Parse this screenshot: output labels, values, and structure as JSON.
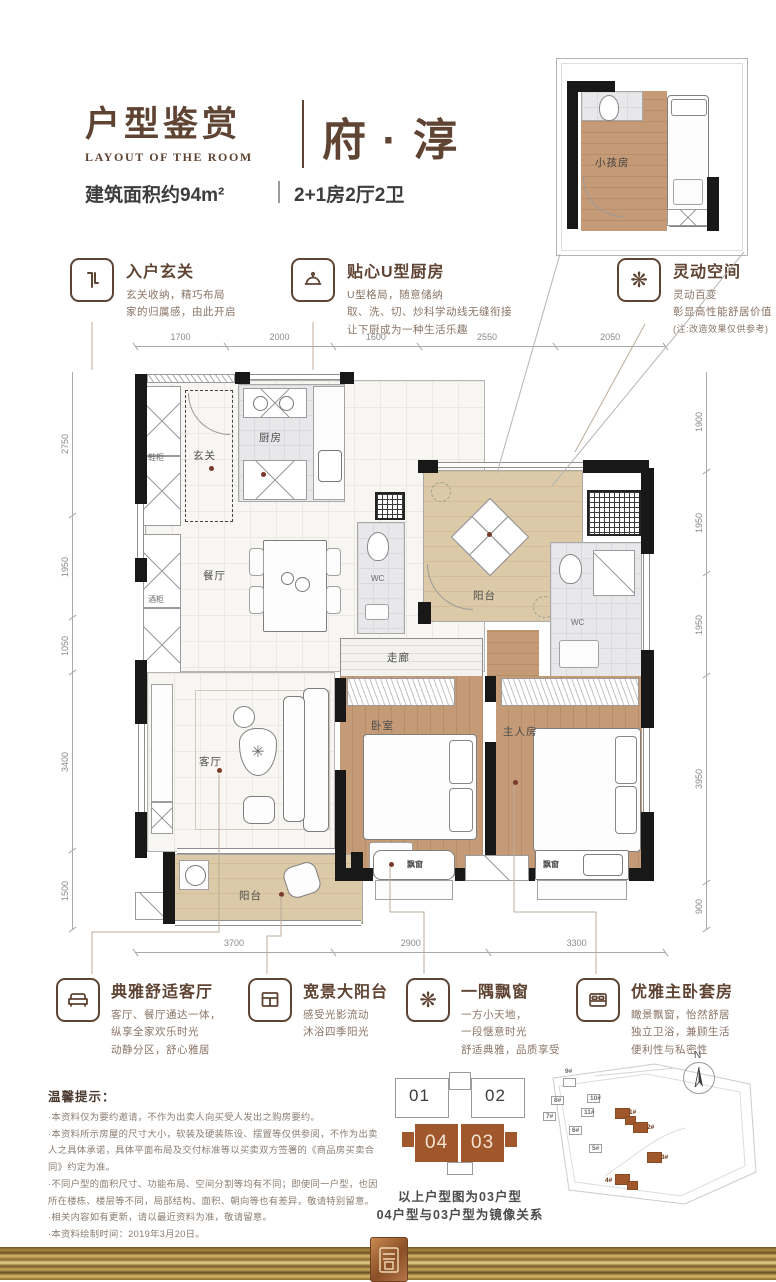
{
  "colors": {
    "accent": "#5f4433",
    "unit_brown": "#a0572b",
    "wall_black": "#181818",
    "wood": "#bf9471",
    "balcony_beige": "#d9c5a3",
    "gold_dark": "#6d5322",
    "gold_light": "#ecd492"
  },
  "header": {
    "title_cn": "户型鉴赏",
    "title_en": "LAYOUT OF THE ROOM",
    "product_name": "府 · 淳",
    "area_text": "建筑面积约94m²",
    "layout_text": "2+1房2厅2卫"
  },
  "features_top": [
    {
      "icon": "foyer-icon",
      "title": "入户玄关",
      "lines": [
        "玄关收纳，精巧布局",
        "家的归属感，由此开启"
      ]
    },
    {
      "icon": "cloche-icon",
      "title": "贴心U型厨房",
      "lines": [
        "U型格局，随意储纳",
        "取、洗、切、炒科学动线无缝衔接",
        "让下厨成为一种生活乐趣"
      ]
    },
    {
      "icon": "flower-icon",
      "title": "灵动空间",
      "lines": [
        "灵动百变",
        "彰显高性能舒居价值",
        "(注:改造效果仅供参考)"
      ]
    }
  ],
  "features_bottom": [
    {
      "icon": "sofa-icon",
      "title": "典雅舒适客厅",
      "lines": [
        "客厅、餐厅通达一体，",
        "纵享全家欢乐时光",
        "动静分区，舒心雅居"
      ]
    },
    {
      "icon": "window-icon",
      "title": "宽景大阳台",
      "lines": [
        "感受光影流动",
        "沐浴四季阳光"
      ]
    },
    {
      "icon": "flower-icon",
      "title": "一隅飘窗",
      "lines": [
        "一方小天地，",
        "一段惬意时光",
        "舒适典雅，品质享受"
      ]
    },
    {
      "icon": "bed-icon",
      "title": "优雅主卧套房",
      "lines": [
        "瞰景飘窗，怡然舒居",
        "独立卫浴，兼顾生活",
        "便利性与私密性"
      ]
    }
  ],
  "dimensions": {
    "top": [
      "1700",
      "2000",
      "1600",
      "2550",
      "2050"
    ],
    "bottom": [
      "3700",
      "2900",
      "3300"
    ],
    "left": [
      "2750",
      "1950",
      "1050",
      "3400",
      "1500"
    ],
    "right": [
      "1900",
      "1950",
      "1950",
      "3950",
      "900"
    ]
  },
  "plan": {
    "inset_label": "小孩房",
    "rooms": [
      {
        "label": "鞋柜"
      },
      {
        "label": "玄关"
      },
      {
        "label": "厨房"
      },
      {
        "label": "酒柜"
      },
      {
        "label": "餐厅"
      },
      {
        "label": "WC"
      },
      {
        "label": "阳台"
      },
      {
        "label": "WC"
      },
      {
        "label": "走廊"
      },
      {
        "label": "客厅"
      },
      {
        "label": "卧室"
      },
      {
        "label": "主人房"
      },
      {
        "label": "阳台"
      },
      {
        "label": "飘窗"
      },
      {
        "label": "飘窗"
      }
    ]
  },
  "notice": {
    "title": "温馨提示：",
    "items": [
      "·本资料仅为要约邀请，不作为出卖人向买受人发出之购房要约。",
      "·本资料所示房屋的尺寸大小，软装及硬装陈设、摆置等仅供参阅，不作为出卖人之具体承诺，具体平面布局及交付标准等以买卖双方签署的《商品房买卖合同》约定为准。",
      "·不同户型的面积尺寸、功能布局、空间分割等均有不同；即使同一户型，也因所在楼栋、楼层等不同，局部结构、面积、朝向等也有差异，敬请特别留意。",
      "·相关内容如有更新，请以最近资料为准，敬请留意。",
      "·本资料绘制时间：2019年3月20日。"
    ]
  },
  "building_diagram": {
    "units": [
      {
        "no": "01"
      },
      {
        "no": "02"
      },
      {
        "no": "04"
      },
      {
        "no": "03"
      }
    ],
    "caption_line1": "以上户型图为03户型",
    "caption_line2": "04户型与03户型为镜像关系"
  },
  "site_map": {
    "compass": "N",
    "buildings": [
      {
        "label": "9#",
        "type": "gray"
      },
      {
        "label": "10#",
        "type": "gray"
      },
      {
        "label": "8#",
        "type": "gray"
      },
      {
        "label": "11#",
        "type": "gray"
      },
      {
        "label": "7#",
        "type": "gray"
      },
      {
        "label": "6#",
        "type": "gray"
      },
      {
        "label": "5#",
        "type": "gray"
      },
      {
        "label": "1#",
        "type": "brown"
      },
      {
        "label": "2#",
        "type": "brown"
      },
      {
        "label": "3#",
        "type": "brown"
      },
      {
        "label": "4#",
        "type": "brown"
      }
    ]
  }
}
